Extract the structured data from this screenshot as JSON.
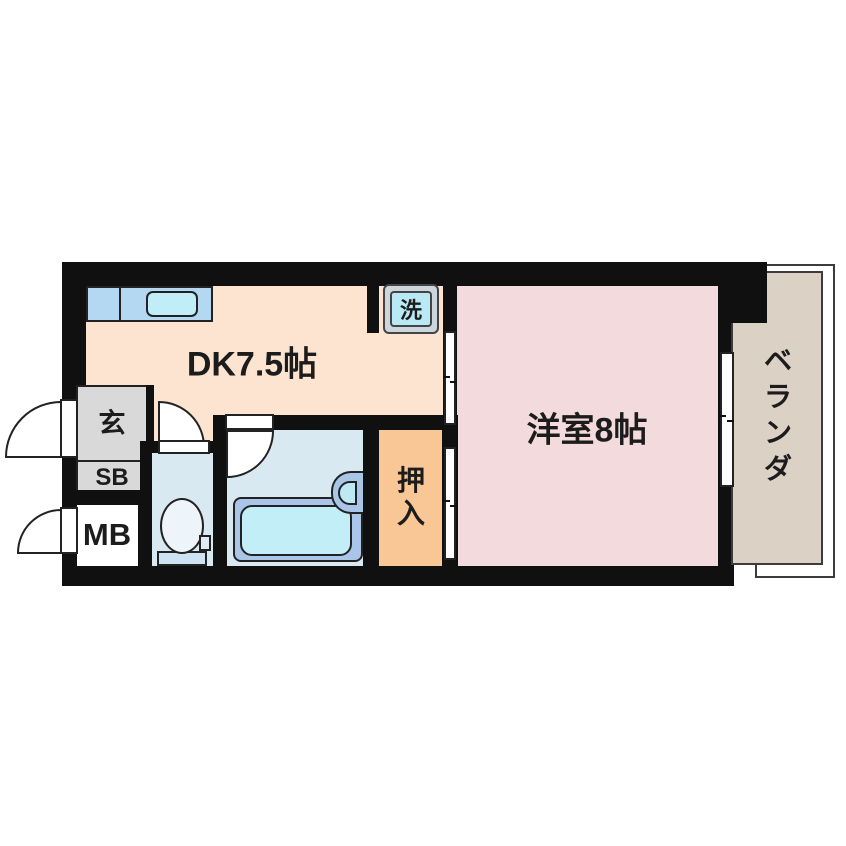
{
  "floorplan": {
    "rooms": {
      "dining_kitchen": {
        "label": "DK7.5帖"
      },
      "western_room": {
        "label": "洋室8帖"
      },
      "veranda": {
        "label": "ベランダ"
      },
      "closet": {
        "label": "押入"
      },
      "entrance": {
        "label": "玄"
      },
      "shoe_box": {
        "label": "SB"
      },
      "meter_box": {
        "label": "MB"
      },
      "washer_pan": {
        "label": "洗"
      }
    },
    "colors": {
      "wall": "#101010",
      "dk_floor": "#fce4d0",
      "western_room_floor": "#f3dadd",
      "closet_floor": "#f8c795",
      "veranda_floor": "#dbd1c5",
      "wet_area_floor": "#d9e9f2",
      "kitchen_counter": "#b4d8f1",
      "sink": "#c0edf8",
      "tub_outer": "#a9c6e8",
      "tub_inner": "#c2eef8",
      "entrance_floor": "#d9d9d9",
      "text": "#1c1c1c",
      "background": "#ffffff"
    }
  }
}
